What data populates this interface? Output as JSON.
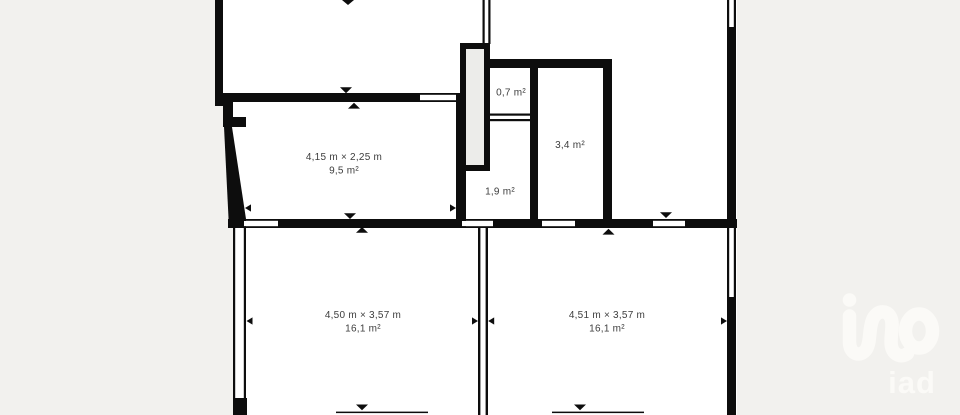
{
  "colors": {
    "background": "#f2f1ee",
    "wall": "#0d0d0d",
    "room": "#ffffff",
    "duct": "#ececea",
    "label": "#3d3d3d",
    "watermark": "#fbfaf7"
  },
  "floorplan": {
    "rooms": [
      {
        "name": "room-9-5",
        "dimensions": "4,15 m × 2,25 m",
        "area": "9,5 m²"
      },
      {
        "name": "room-0-7",
        "area": "0,7 m²"
      },
      {
        "name": "room-3-4",
        "area": "3,4 m²"
      },
      {
        "name": "room-1-9",
        "area": "1,9 m²"
      },
      {
        "name": "room-16-1-left",
        "dimensions": "4,50 m × 3,57 m",
        "area": "16,1 m²"
      },
      {
        "name": "room-16-1-right",
        "dimensions": "4,51 m × 3,57 m",
        "area": "16,1 m²"
      }
    ]
  },
  "watermark": {
    "brand": "iad"
  }
}
